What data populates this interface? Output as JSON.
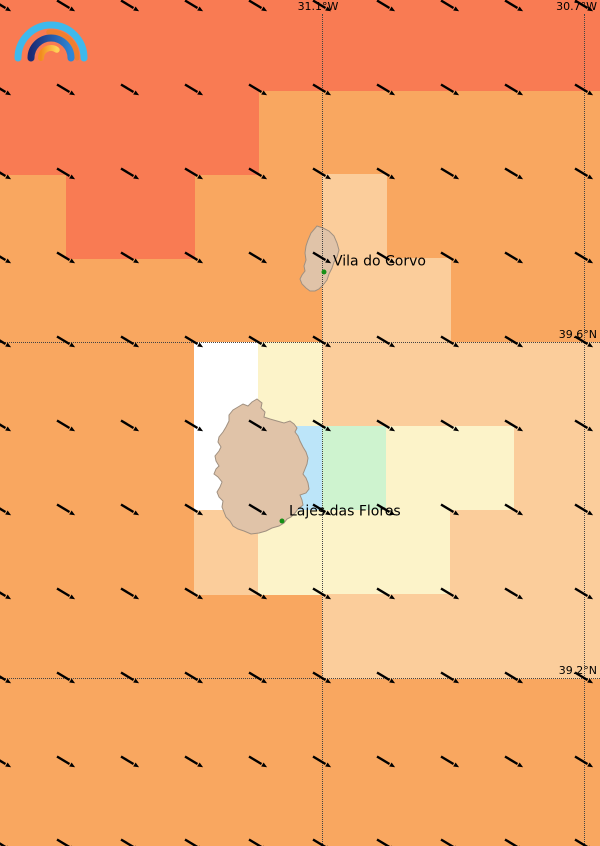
{
  "map": {
    "width": 600,
    "height": 846,
    "background": "#F9A760",
    "palette": {
      "A": "#F97B53",
      "B": "#F9A760",
      "C": "#FBCD9B",
      "E": "#FCF3C9",
      "F": "#FFFFFF",
      "G": "#BCE5F9",
      "H": "#CEF3CF"
    },
    "grid": {
      "col_edges": [
        0,
        66,
        130,
        194,
        258,
        322,
        386,
        450,
        514,
        578,
        600
      ],
      "row_edges": [
        0,
        90,
        174,
        258,
        342,
        426,
        510,
        594,
        678,
        762,
        846
      ],
      "rows": [
        "AAAAAAAAAA",
        "AAAABBBBBB",
        "BAABBCBBBB",
        "BBBBBCCBBB",
        "BBBFECCCCC",
        "BBBFGHEECC",
        "BBBCEEECCC",
        "BBBBBCCCCC",
        "BBBBBBBBBB",
        "BBBBBBBBBB"
      ]
    },
    "meridians": [
      {
        "label": "31.1°W",
        "x": 322
      },
      {
        "label": "30.7°W",
        "x": 584
      }
    ],
    "parallels": [
      {
        "label": "39.6°N",
        "y": 342
      },
      {
        "label": "39.2°N",
        "y": 678
      }
    ],
    "gridline_color": "#444444",
    "wind_grid": {
      "cols_x": [
        2,
        66,
        130,
        194,
        258,
        322,
        386,
        450,
        514,
        584
      ],
      "rows_y": [
        6,
        90,
        174,
        258,
        342,
        426,
        510,
        594,
        678,
        762,
        845
      ],
      "direction": "from-northwest",
      "barb_color": "#000000"
    },
    "islands": [
      {
        "name": "Corvo",
        "fill": "#E0C3A8",
        "stroke": "#A09080",
        "points": "317,226 323,228 329,231 334,236 337,243 339,250 337,257 334,262 332,268 329,274 327,280 323,285 319,289 315,291 310,291 306,288 302,284 300,279 302,275 305,271 304,266 306,260 305,253 306,246 308,240 311,233"
      },
      {
        "name": "Flores",
        "fill": "#E0C3A8",
        "stroke": "#A09080",
        "points": "257,399 262,403 261,408 265,412 264,417 270,419 277,421 284,423 290,421 294,424 297,428 295,432 298,436 300,441 303,447 306,452 308,458 307,464 305,469 303,474 306,478 308,483 309,489 306,493 300,495 302,500 303,505 298,509 295,513 291,517 287,519 284,523 279,526 272,528 266,531 259,533 251,534 244,531 238,529 233,526 230,521 226,517 224,512 222,507 223,501 219,497 217,492 220,487 222,482 218,477 214,474 216,469 219,466 216,461 215,456 219,451 221,447 218,442 219,437 223,432 226,427 229,421 229,415 233,410 238,407 243,404 248,406 252,402"
      }
    ],
    "places": [
      {
        "name": "Vila do Corvo",
        "dot_x": 324,
        "dot_y": 272,
        "label_x": 333,
        "label_y": 262,
        "dot_color": "#169016"
      },
      {
        "name": "Lajes das Flores",
        "dot_x": 282,
        "dot_y": 521,
        "label_x": 289,
        "label_y": 512,
        "dot_color": "#169016"
      }
    ],
    "logo": {
      "outer_arc_color": "#3FB9EC",
      "orange_arc_color": "#F07F2E",
      "navy_arc_color": "#1B2B74",
      "navy_arc_color2": "#2F86D6",
      "inner_arc_color": "#F28C1E",
      "inner_arc_color2": "#FFD257"
    }
  }
}
